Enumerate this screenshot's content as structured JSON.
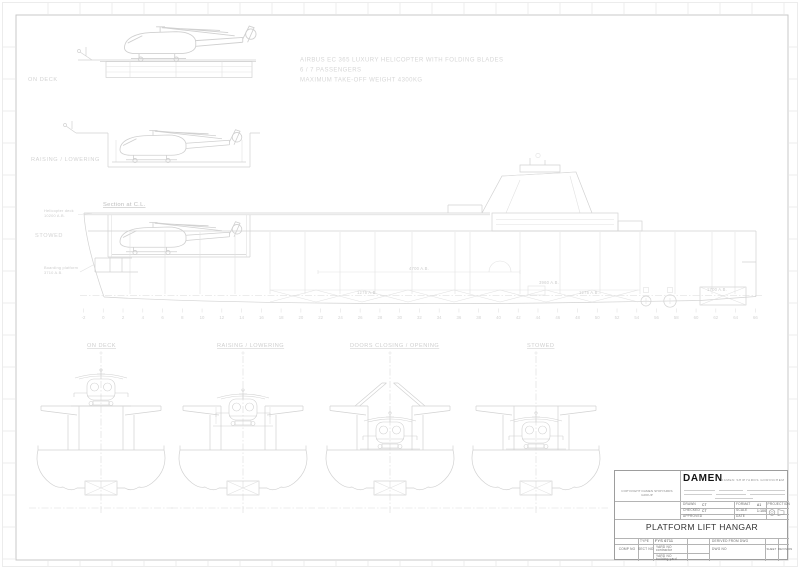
{
  "colors": {
    "drawing_line": "#d2d2d2",
    "faint_line": "#e2e2e2",
    "drawing_text": "#cfcfcf",
    "titleblock_line": "#b4b4b4",
    "ink": "#323232"
  },
  "drawing": {
    "notes": [
      "AIRBUS EC 365 LUXURY HELICOPTER WITH FOLDING BLADES",
      "6 / 7 PASSENGERS",
      "MAXIMUM TAKE-OFF WEIGHT 4300KG"
    ],
    "state_labels": {
      "on_deck": "ON DECK",
      "raising_lowering": "RAISING / LOWERING",
      "stowed": "STOWED"
    },
    "section_title": "Section at C.L.",
    "callouts": {
      "heli_deck_1": "Helicopter deck",
      "heli_deck_2": "10200 A.B.",
      "boarding_1": "Boarding platform",
      "boarding_2": "3710 A.B."
    },
    "dimensions": {
      "d4700": "4700 A.B.",
      "d3960": "3960 A.B.",
      "d1275a": "1275 A.B.",
      "d1275b": "1275 A.B.",
      "d1700": "1700 A.B."
    },
    "bottom_labels": [
      "ON DECK",
      "RAISING / LOWERING",
      "DOORS CLOSING / OPENING",
      "STOWED"
    ],
    "frame_numbers": [
      -2,
      0,
      2,
      4,
      6,
      8,
      10,
      12,
      14,
      16,
      18,
      20,
      22,
      24,
      26,
      28,
      30,
      32,
      34,
      36,
      38,
      40,
      42,
      44,
      46,
      48,
      50,
      52,
      54,
      56,
      58,
      60,
      62,
      64,
      66
    ]
  },
  "titleblock": {
    "copyright": "COPYRIGHT DAMEN SHIPYARDS GROUP",
    "logo": "DAMEN",
    "logo_sub": "DAMEN SHIPYARDS GORINCHEM",
    "title": "PLATFORM LIFT HANGAR",
    "drawn_label": "DRAWN",
    "drawn_value": "CT",
    "checked_label": "CHECKED",
    "checked_value": "CT",
    "approved_label": "APPROVED",
    "format_label": "FORMAT",
    "format_value": "A1",
    "scale_label": "SCALE",
    "scale_value": "1:100",
    "date_label": "DATE",
    "projection_label": "PROJECTION",
    "type_label": "TYPE",
    "type_value": "FYS 6711",
    "derived_label": "DERIVED FROM DWG",
    "comp_no_label": "COMP NO",
    "sect_no_label": "SECT NO",
    "yard_contractor_1": "YARD NO",
    "yard_contractor_2": "contractor",
    "yard_building_1": "YARD NO",
    "yard_building_2": "building yard",
    "dwg_no_label": "DWG NO",
    "sheet_label": "SHEET",
    "revision_label": "REVISION"
  }
}
